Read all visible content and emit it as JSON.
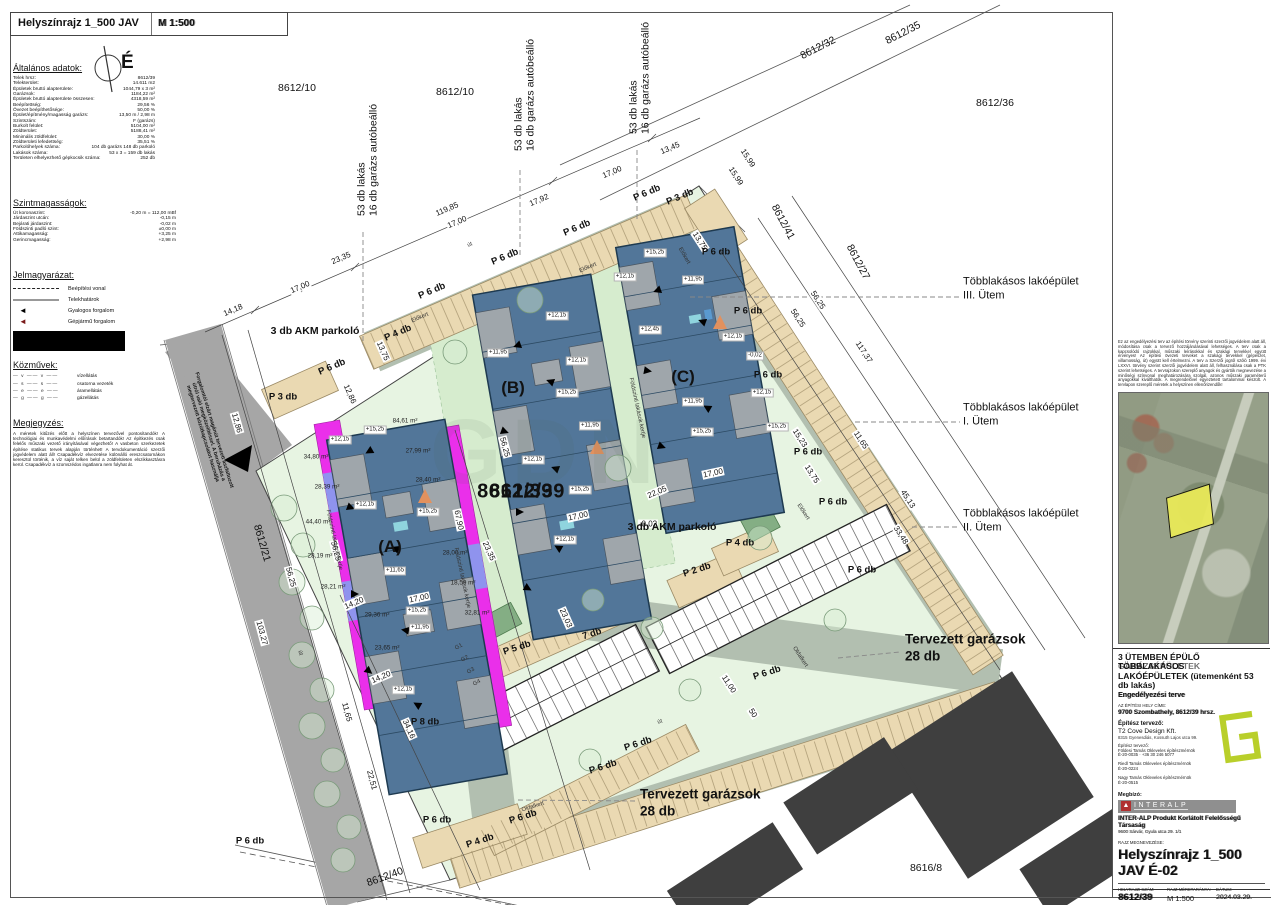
{
  "header": {
    "title": "Helyszínrajz 1_500 JAV",
    "scale": "M 1:500",
    "north_letter": "É"
  },
  "colors": {
    "site_green": "#e7f4e2",
    "garden_green": "#d6ecce",
    "sage_road": "#b2bfb0",
    "public_road": "#a6a6a6",
    "parking_tan": "#ead9b2",
    "building_blue": "#527699",
    "patio_gray": "#9fa6ab",
    "magenta_strip": "#ea2fea",
    "violet_strip": "#8f93ee",
    "existing_dark": "#3f3f3f",
    "logo_green": "#b9cf2a",
    "interalp_red": "#b03030",
    "parcel_yellow": "#e9e958"
  },
  "left_panel": {
    "general_title": "Általános adatok:",
    "general_rows": [
      {
        "label": "Telek hrsz:",
        "value": "8612/39"
      },
      {
        "label": "Telekterület:",
        "value": "14.611 m2"
      },
      {
        "label": "Épületek bruttó alapterülete:",
        "value": "1044,79 x 3 m²"
      },
      {
        "label": "Garázsok:",
        "value": "1184,22 m²"
      },
      {
        "label": "Épületek bruttó alapterülete összesen:",
        "value": "4318,59 m²"
      },
      {
        "label": "Beépítettség:",
        "value": "29,56 %"
      },
      {
        "label": "Övezet beépíthetősége:",
        "value": "50,00 %"
      },
      {
        "label": "Épület/építmény/magasság garázs:",
        "value": "13,50 m / 2,98 m"
      },
      {
        "label": "Szintszám:",
        "value": "F (garázs)"
      },
      {
        "label": "Burkolt felület:",
        "value": "5104,00 m²"
      },
      {
        "label": "Zöldterület:",
        "value": "5188,41 m²"
      },
      {
        "label": "Minimális zöldfelület:",
        "value": "30,00 %"
      },
      {
        "label": "Zöldterületi lefedettség:",
        "value": "35,51 %"
      },
      {
        "label": "Parkolóhelyek száma:",
        "value": "104 db garázs 148 db parkoló"
      },
      {
        "label": "Lakások száma:",
        "value": "53 x 3 = 159 db lakás"
      },
      {
        "label": "Területen elhelyezhető gépkocsik száma:",
        "value": "252 db"
      }
    ],
    "levels_title": "Szintmagasságok:",
    "levels_rows": [
      {
        "label": "Út koronaszint:",
        "value": "-0,20 m = 112,00 mBf"
      },
      {
        "label": "Járdaszint utcán:",
        "value": "-0,15 m"
      },
      {
        "label": "Bejárati járdaszint:",
        "value": "-0,02 m"
      },
      {
        "label": "Földszinti padló szint:",
        "value": "±0,00 m"
      },
      {
        "label": "Attikamagasság:",
        "value": "+3,25 m"
      },
      {
        "label": "Gerincmagasság:",
        "value": "+2,98 m"
      }
    ],
    "legend_title": "Jelmagyarázat:",
    "legend_items": [
      {
        "type": "dashed",
        "label": "Beépítési vonal"
      },
      {
        "type": "solid",
        "label": "Telekhatárok"
      },
      {
        "type": "arrow-black",
        "label": "Gyalogos forgalom"
      },
      {
        "type": "arrow-red",
        "label": "Gépjármű forgalom"
      }
    ],
    "utilities_title": "Közművek:",
    "utilities_items": [
      {
        "sym": "— v —— v ——",
        "label": "vízellátás"
      },
      {
        "sym": "— s —— s ——",
        "label": "csatorna vezeték"
      },
      {
        "sym": "— e —— e ——",
        "label": "áramellátás"
      },
      {
        "sym": "— g —— g ——",
        "label": "gázellátás"
      }
    ],
    "notes_title": "Megjegyzés:",
    "notes_text": "A méretek kitűzés előtt a helyszínen tervezővel pontosítandók! A technológiai és munkavédelmi előírások betartandók! Az építkezés csak felelős műszaki vezető irányításával végezhető! A vasbeton szerkezetek építése statikus tervek alapján történhet! A tervdokumentáció szerzői jogvédelem alatt áll! Csapadékvíz elvezetése különálló ereszcsatornákon keresztül történik, a víz saját telken belül a zöldfelületen elszikkasztásra kerül. Csapadékvíz a szomszédos ingatlanra nem folyhat át."
  },
  "plan": {
    "watermark": "GDN",
    "big_parcel": {
      "t": "8612/39",
      "x": 515,
      "y": 492
    },
    "parcel_labels": [
      {
        "t": "8612/10",
        "x": 297,
        "y": 88,
        "r": 0
      },
      {
        "t": "8612/10",
        "x": 455,
        "y": 92,
        "r": 0
      },
      {
        "t": "8612/32",
        "x": 818,
        "y": 48,
        "r": -27
      },
      {
        "t": "8612/35",
        "x": 903,
        "y": 33,
        "r": -27
      },
      {
        "t": "8612/36",
        "x": 995,
        "y": 103,
        "r": 0
      },
      {
        "t": "8612/41",
        "x": 783,
        "y": 222,
        "r": 62
      },
      {
        "t": "8612/27",
        "x": 858,
        "y": 262,
        "r": 62
      },
      {
        "t": "8612/21",
        "x": 262,
        "y": 543,
        "r": 74
      },
      {
        "t": "8612/40",
        "x": 385,
        "y": 877,
        "r": -20
      },
      {
        "t": "8616/8",
        "x": 926,
        "y": 868,
        "r": 0
      }
    ],
    "vertical_labels": [
      {
        "line1": "53 db lakás",
        "line2": "16 db garázs autóbeálló",
        "x": 368,
        "y": 160
      },
      {
        "line1": "53 db lakás",
        "line2": "16 db garázs autóbeálló",
        "x": 525,
        "y": 95
      },
      {
        "line1": "53 db lakás",
        "line2": "16 db garázs autóbeálló",
        "x": 640,
        "y": 78
      }
    ],
    "dims": [
      {
        "t": "119,85",
        "x": 447,
        "y": 209,
        "r": -23
      },
      {
        "t": "17,00",
        "x": 457,
        "y": 222,
        "r": -23
      },
      {
        "t": "17,92",
        "x": 539,
        "y": 200,
        "r": -23
      },
      {
        "t": "17,00",
        "x": 612,
        "y": 172,
        "r": -23
      },
      {
        "t": "13,45",
        "x": 670,
        "y": 148,
        "r": -23
      },
      {
        "t": "15,99",
        "x": 748,
        "y": 158,
        "r": 57
      },
      {
        "t": "15,99",
        "x": 736,
        "y": 176,
        "r": 57
      },
      {
        "t": "23,35",
        "x": 341,
        "y": 258,
        "r": -23
      },
      {
        "t": "17,00",
        "x": 300,
        "y": 287,
        "r": -23
      },
      {
        "t": "14,18",
        "x": 233,
        "y": 310,
        "r": -23
      },
      {
        "t": "13,75",
        "x": 700,
        "y": 241,
        "r": 57
      },
      {
        "t": "12,86",
        "x": 237,
        "y": 423,
        "r": 74
      },
      {
        "t": "12,86",
        "x": 350,
        "y": 394,
        "r": 66
      },
      {
        "t": "13,75",
        "x": 383,
        "y": 351,
        "r": 66
      },
      {
        "t": "56,25",
        "x": 336,
        "y": 551,
        "r": 75
      },
      {
        "t": "56,25",
        "x": 291,
        "y": 577,
        "r": 75
      },
      {
        "t": "14,20",
        "x": 354,
        "y": 603,
        "r": -23
      },
      {
        "t": "14,20",
        "x": 381,
        "y": 677,
        "r": -23
      },
      {
        "t": "103,27",
        "x": 262,
        "y": 633,
        "r": 75
      },
      {
        "t": "11,65",
        "x": 347,
        "y": 712,
        "r": 75
      },
      {
        "t": "22,51",
        "x": 372,
        "y": 780,
        "r": 75
      },
      {
        "t": "34,16",
        "x": 409,
        "y": 729,
        "r": 66
      },
      {
        "t": "23,35",
        "x": 489,
        "y": 551,
        "r": 66
      },
      {
        "t": "23,03",
        "x": 566,
        "y": 618,
        "r": 66
      },
      {
        "t": "67,90",
        "x": 459,
        "y": 520,
        "r": 78
      },
      {
        "t": "17,00",
        "x": 419,
        "y": 598,
        "r": -12
      },
      {
        "t": "17,00",
        "x": 578,
        "y": 516,
        "r": -12
      },
      {
        "t": "17,00",
        "x": 713,
        "y": 473,
        "r": -12
      },
      {
        "t": "56,25",
        "x": 505,
        "y": 447,
        "r": 75
      },
      {
        "t": "56,25",
        "x": 818,
        "y": 300,
        "r": 57
      },
      {
        "t": "56,25",
        "x": 798,
        "y": 318,
        "r": 57
      },
      {
        "t": "117,37",
        "x": 864,
        "y": 352,
        "r": 57
      },
      {
        "t": "11,65",
        "x": 861,
        "y": 440,
        "r": 57
      },
      {
        "t": "45,13",
        "x": 908,
        "y": 499,
        "r": 57
      },
      {
        "t": "33,48",
        "x": 901,
        "y": 535,
        "r": 57
      },
      {
        "t": "15,23",
        "x": 800,
        "y": 438,
        "r": 57
      },
      {
        "t": "13,75",
        "x": 812,
        "y": 474,
        "r": 57
      },
      {
        "t": "22,05",
        "x": 657,
        "y": 492,
        "r": -23
      },
      {
        "t": "11,00",
        "x": 729,
        "y": 684,
        "r": 57
      },
      {
        "t": "50",
        "x": 753,
        "y": 713,
        "r": 57
      },
      {
        "t": "-0,02",
        "x": 648,
        "y": 524,
        "r": 0
      }
    ],
    "parking": [
      {
        "t": "P 6 db",
        "x": 647,
        "y": 193,
        "r": -23
      },
      {
        "t": "P 6 db",
        "x": 577,
        "y": 228,
        "r": -23
      },
      {
        "t": "P 6 db",
        "x": 505,
        "y": 257,
        "r": -23
      },
      {
        "t": "P 6 db",
        "x": 432,
        "y": 291,
        "r": -23
      },
      {
        "t": "P 4 db",
        "x": 398,
        "y": 333,
        "r": -23
      },
      {
        "t": "P 6 db",
        "x": 332,
        "y": 367,
        "r": -23
      },
      {
        "t": "P 3 db",
        "x": 680,
        "y": 197,
        "r": -23
      },
      {
        "t": "P 3 db",
        "x": 283,
        "y": 397,
        "r": 0
      },
      {
        "t": "P 6 db",
        "x": 716,
        "y": 252,
        "r": 0
      },
      {
        "t": "P 6 db",
        "x": 748,
        "y": 311,
        "r": 0
      },
      {
        "t": "P 6 db",
        "x": 768,
        "y": 375,
        "r": 0
      },
      {
        "t": "P 6 db",
        "x": 808,
        "y": 452,
        "r": 0
      },
      {
        "t": "P 6 db",
        "x": 833,
        "y": 502,
        "r": 0
      },
      {
        "t": "P 6 db",
        "x": 862,
        "y": 570,
        "r": 0
      },
      {
        "t": "P 6 db",
        "x": 767,
        "y": 673,
        "r": -18
      },
      {
        "t": "P 6 db",
        "x": 638,
        "y": 744,
        "r": -18
      },
      {
        "t": "P 6 db",
        "x": 603,
        "y": 767,
        "r": -18
      },
      {
        "t": "P 6 db",
        "x": 523,
        "y": 817,
        "r": -18
      },
      {
        "t": "P 6 db",
        "x": 437,
        "y": 820,
        "r": 0
      },
      {
        "t": "P 6 db",
        "x": 250,
        "y": 841,
        "r": 0
      },
      {
        "t": "P 4 db",
        "x": 740,
        "y": 543,
        "r": 0
      },
      {
        "t": "P 4 db",
        "x": 480,
        "y": 841,
        "r": -18
      },
      {
        "t": "P 2 db",
        "x": 697,
        "y": 570,
        "r": -18
      },
      {
        "t": "P 5 db",
        "x": 517,
        "y": 648,
        "r": -18
      },
      {
        "t": "7 db",
        "x": 592,
        "y": 634,
        "r": -18
      },
      {
        "t": "P 8 db",
        "x": 425,
        "y": 722,
        "r": 0
      }
    ],
    "chips": [
      {
        "t": "+15,25",
        "x": 375,
        "y": 430
      },
      {
        "t": "+12,15",
        "x": 340,
        "y": 440
      },
      {
        "t": "+12,15",
        "x": 365,
        "y": 505
      },
      {
        "t": "+15,25",
        "x": 428,
        "y": 512
      },
      {
        "t": "+11,65",
        "x": 395,
        "y": 571
      },
      {
        "t": "+15,25",
        "x": 417,
        "y": 611
      },
      {
        "t": "+11,95",
        "x": 420,
        "y": 628
      },
      {
        "t": "+12,15",
        "x": 403,
        "y": 690
      },
      {
        "t": "+12,15",
        "x": 557,
        "y": 316
      },
      {
        "t": "+11,95",
        "x": 498,
        "y": 353
      },
      {
        "t": "+12,15",
        "x": 577,
        "y": 361
      },
      {
        "t": "+15,25",
        "x": 567,
        "y": 393
      },
      {
        "t": "+11,95",
        "x": 590,
        "y": 426
      },
      {
        "t": "+12,15",
        "x": 533,
        "y": 460
      },
      {
        "t": "+15,25",
        "x": 580,
        "y": 490
      },
      {
        "t": "+12,15",
        "x": 565,
        "y": 540
      },
      {
        "t": "+15,25",
        "x": 655,
        "y": 253
      },
      {
        "t": "+12,15",
        "x": 625,
        "y": 277
      },
      {
        "t": "+11,95",
        "x": 693,
        "y": 280
      },
      {
        "t": "+12,45",
        "x": 650,
        "y": 330
      },
      {
        "t": "+11,95",
        "x": 693,
        "y": 402
      },
      {
        "t": "+15,25",
        "x": 702,
        "y": 432
      },
      {
        "t": "+12,15",
        "x": 733,
        "y": 337
      },
      {
        "t": "-0,02",
        "x": 755,
        "y": 356
      },
      {
        "t": "+12,15",
        "x": 762,
        "y": 393
      },
      {
        "t": "+15,25",
        "x": 777,
        "y": 427
      }
    ],
    "areas": [
      {
        "t": "34,80 m²",
        "x": 316,
        "y": 457
      },
      {
        "t": "28,39 m²",
        "x": 327,
        "y": 487
      },
      {
        "t": "44,40 m²",
        "x": 318,
        "y": 522
      },
      {
        "t": "28,19 m²",
        "x": 320,
        "y": 556
      },
      {
        "t": "28,21 m²",
        "x": 333,
        "y": 587
      },
      {
        "t": "29,36 m²",
        "x": 377,
        "y": 615
      },
      {
        "t": "23,65 m²",
        "x": 387,
        "y": 648
      },
      {
        "t": "84,61 m²",
        "x": 405,
        "y": 421
      },
      {
        "t": "27,99 m²",
        "x": 418,
        "y": 451
      },
      {
        "t": "28,40 m²",
        "x": 428,
        "y": 480
      },
      {
        "t": "28,00 m²",
        "x": 455,
        "y": 553
      },
      {
        "t": "18,59 m²",
        "x": 463,
        "y": 583
      },
      {
        "t": "32,81 m²",
        "x": 477,
        "y": 613
      }
    ],
    "small_labels": [
      {
        "t": "út",
        "x": 470,
        "y": 245,
        "r": -23
      },
      {
        "t": "út",
        "x": 300,
        "y": 653,
        "r": 75
      },
      {
        "t": "út",
        "x": 660,
        "y": 722,
        "r": -18
      },
      {
        "t": "Előkert",
        "x": 588,
        "y": 268,
        "r": -23
      },
      {
        "t": "Előkert",
        "x": 684,
        "y": 256,
        "r": 60
      },
      {
        "t": "Előkert",
        "x": 420,
        "y": 318,
        "r": -23
      },
      {
        "t": "Előkert",
        "x": 803,
        "y": 512,
        "r": 57
      },
      {
        "t": "Oldalkert",
        "x": 800,
        "y": 657,
        "r": 57
      },
      {
        "t": "Oldalkert",
        "x": 533,
        "y": 807,
        "r": -18
      },
      {
        "t": "Földszinti lakások kertje",
        "x": 334,
        "y": 540,
        "r": 78
      },
      {
        "t": "Földszinti lakások kertje",
        "x": 462,
        "y": 578,
        "r": 78
      },
      {
        "t": "Földszinti lakások kertje",
        "x": 637,
        "y": 408,
        "r": 78
      },
      {
        "t": "G1",
        "x": 459,
        "y": 647,
        "r": -28
      },
      {
        "t": "G2",
        "x": 465,
        "y": 659,
        "r": -28
      },
      {
        "t": "G3",
        "x": 471,
        "y": 671,
        "r": -28
      },
      {
        "t": "G4",
        "x": 477,
        "y": 683,
        "r": -28
      }
    ],
    "building_labels": [
      {
        "t": "(A)",
        "x": 390,
        "y": 547,
        "r": 0
      },
      {
        "t": "(B)",
        "x": 513,
        "y": 388,
        "r": 0
      },
      {
        "t": "(C)",
        "x": 683,
        "y": 377,
        "r": 0
      }
    ],
    "akm_labels": [
      {
        "t": "3 db AKM parkoló",
        "x": 315,
        "y": 331,
        "r": 0
      },
      {
        "t": "3 db AKM parkoló",
        "x": 672,
        "y": 527,
        "r": 0
      }
    ],
    "phase_labels": [
      {
        "line1": "Többlakásos lakóépület",
        "line2": "III. Ütem",
        "x": 963,
        "y": 289
      },
      {
        "line1": "Többlakásos lakóépület",
        "line2": "I. Ütem",
        "x": 963,
        "y": 415
      },
      {
        "line1": "Többlakásos lakóépület",
        "line2": "II. Ütem",
        "x": 963,
        "y": 521
      }
    ],
    "garage_titles": [
      {
        "line1": "Tervezett garázsok",
        "line2": "28 db",
        "x": 905,
        "y": 648
      },
      {
        "line1": "Tervezett garázsok",
        "line2": "28 db",
        "x": 640,
        "y": 803
      }
    ],
    "road_note": {
      "line1": "Forgalomtól elzárt magánút tervezett aszfaltozott",
      "line2": "útról való megközelítéssel. A beruházás a",
      "line3": "megtervezett közútkapcsolatot használja",
      "x": 208,
      "y": 432,
      "r": 73
    }
  },
  "titleblock": {
    "legal_text": "Ez az engedélyezési terv az építési törvény szerinti szerzői jogvédelem alatt áll, módosítása csak a tervező hozzájárulásával lehetséges. A terv csak a kapcsolódó rajzokkal, műszaki leírásokkal és szakági tervekkel együtt érvényes! Az építési övezeti terveket a szakági tervekkel (gépészet, villamosság, út) együtt kell értelmezni. A terv a Szerzői jogról szóló 1999. évi LXXVI. törvény szerint szerzői jogvédelem alatt áll, felhasználása csak a PTK szerint lehetséges. A tervrajzokon szereplő anyagok és gyártók megnevezése a minőségi színvonal meghatározására szolgál, azonos műszaki paraméterű anyagokkal kiválthatók. A megrendelővel egyeztetett tartalommal készült. A tervlapon szereplő méretek a helyszínen ellenőrizendők!",
    "project_title_1": "3 ÜTEMBEN ÉPÜLŐ TÖBBLAKÁSOS",
    "project_title_2": "LAKÓÉPÜLETEK (ütemenként 53 db lakás)",
    "project_title_ghost": "GARÁZSÉPÜLETEK",
    "project_sub": "Engedélyezési terve",
    "site_label": "AZ ÉPÍTÉSI HELY CÍME:",
    "site_address": "9700 Szombathely, 8612/39 hrsz.",
    "designer_label": "Építész tervező:",
    "designer_name": "T2 Cove Design Kft.",
    "designer_addr": "8315 Gyenesdiás, Kossuth Lajos utca 99.",
    "architect_label": "Építész tervező:",
    "architect_1": "Földesi Tamás Okleveles építészmérnök",
    "architect_1b": "É-20-0035  ·  +36 30 246 5077",
    "architect_2": "Riedl Tamás Okleveles építészmérnök",
    "architect_2b": "É-20-0224",
    "architect_3": "Nagy Tamás Okleveles építészmérnök",
    "architect_3b": "É-20-0515",
    "client_label": "Megbízó:",
    "interalp_word": "INTERALP",
    "interalp_mark": "▲",
    "client_name": "INTER-ALP Produkt Korlátolt Felelősségű Társaság",
    "client_addr": "9600 Sárvár, Gyula utca 29. 1/1",
    "drawing_label": "RAJZ MEGNEVEZÉSE:",
    "drawing_name": "Helyszínrajz 1_500 JAV É-02",
    "hrsz_label": "HELYRAJZI SZÁM:",
    "hrsz_value": "8612/39",
    "scale_label": "RAJZ MÉRETARÁNYA:",
    "scale_value": "M 1:500",
    "date_label": "DÁTUM:",
    "date_value": "2024.03.29."
  }
}
